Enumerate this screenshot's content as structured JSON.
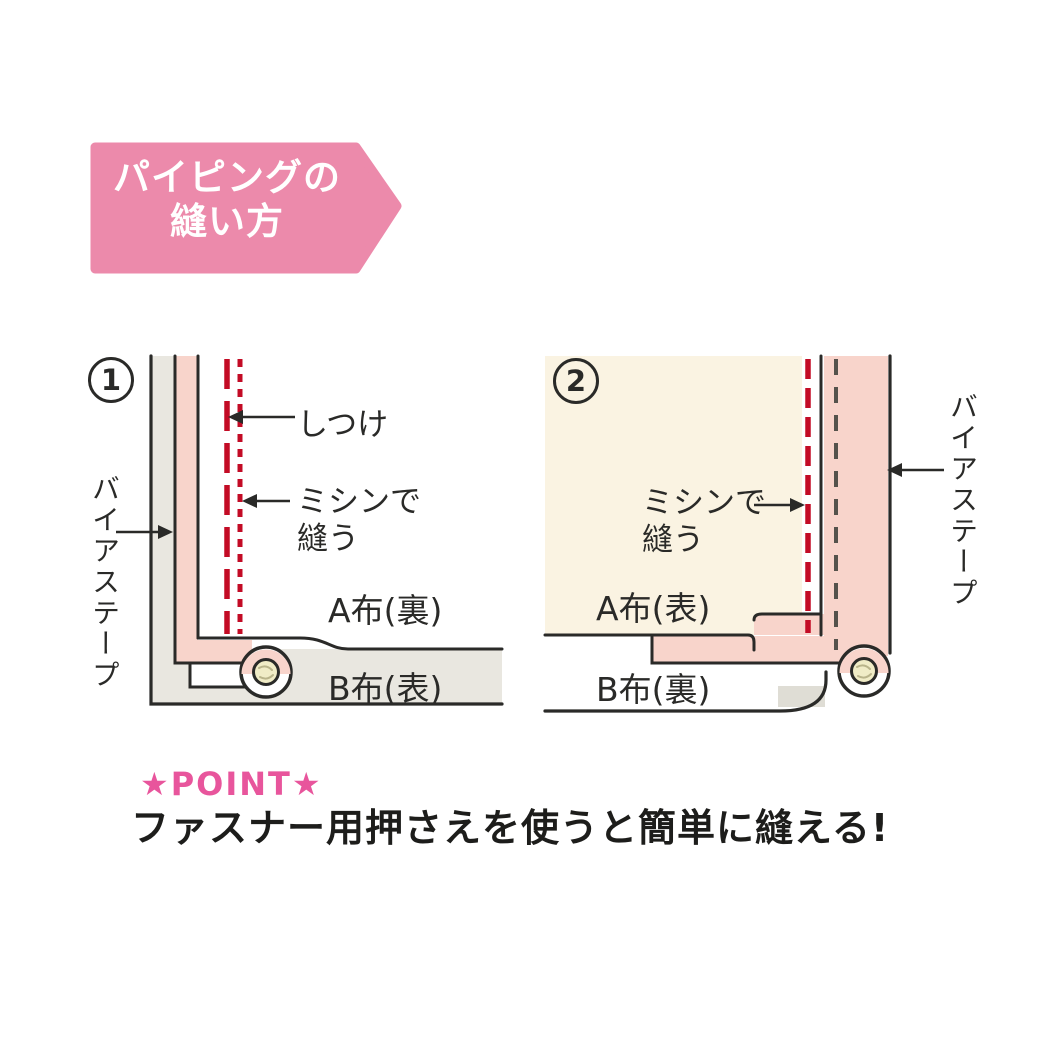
{
  "banner": {
    "title_line1": "パイピングの",
    "title_line2": "縫い方"
  },
  "diagrams": [
    {
      "number": "1",
      "basting_label": "しつけ",
      "machine_line1": "ミシンで",
      "machine_line2": "縫う",
      "fabric_a_label": "A布(裏)",
      "fabric_b_label": "B布(表)",
      "bias_tape_label": "バイアステープ"
    },
    {
      "number": "2",
      "machine_line1": "ミシンで",
      "machine_line2": "縫う",
      "fabric_a_label": "A布(表)",
      "fabric_b_label": "B布(裏)",
      "bias_tape_label": "バイアステープ"
    }
  ],
  "point": {
    "heading": "★POINT★",
    "text": "ファスナー用押さえを使うと簡単に縫える!"
  },
  "colors": {
    "banner_pink": "#ec8aab",
    "tape_pink": "#f8d4cb",
    "fabric_cream": "#faf3e2",
    "fabric_gray": "#e9e7e0",
    "stitch_red": "#c30b25",
    "basting_gray": "#55524c",
    "cord_cream": "#f0ecc6",
    "point_pink": "#e8559c"
  }
}
